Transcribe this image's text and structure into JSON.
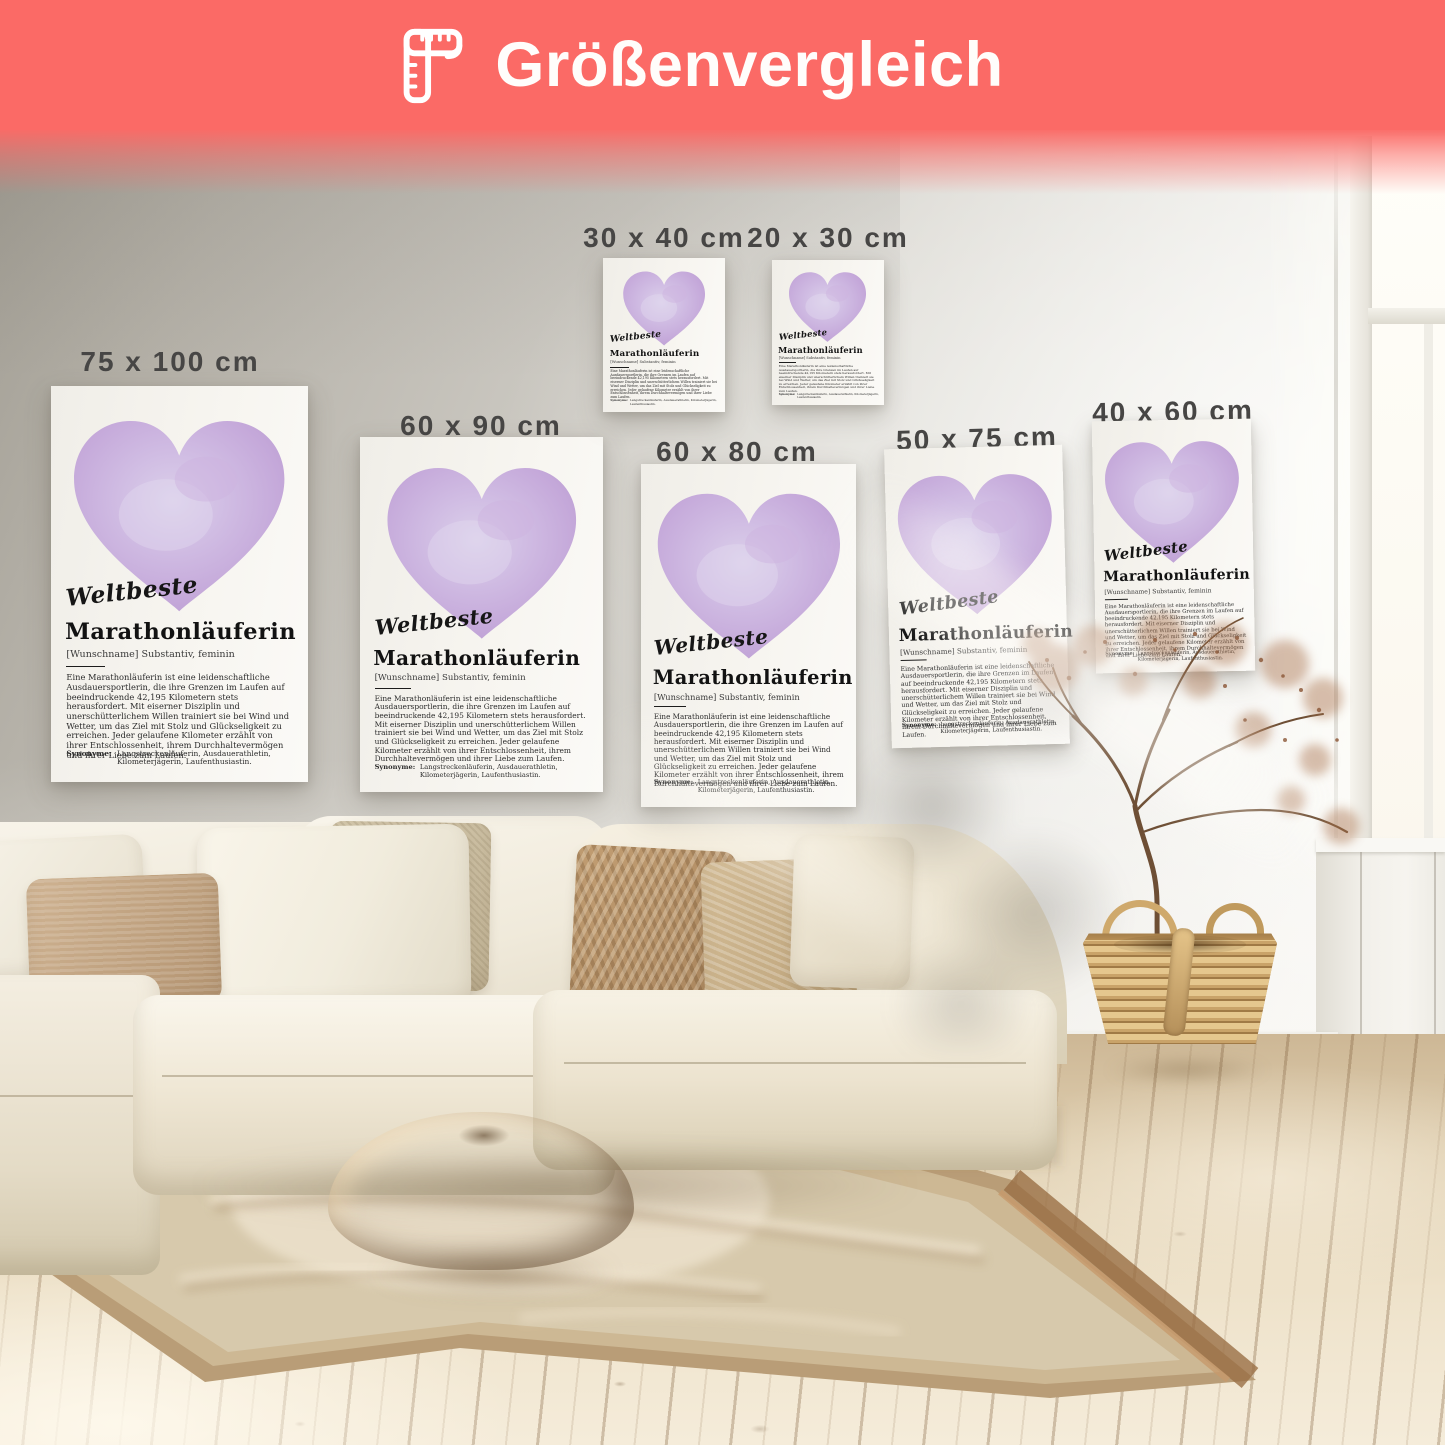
{
  "header": {
    "title": "Größenvergleich",
    "background_color": "#fb6a66",
    "text_color": "#fffdfb",
    "icon": "folding-ruler-icon"
  },
  "posters": {
    "sizes": [
      "75 x 100 cm",
      "60 x 90 cm",
      "30 x 40 cm",
      "20 x 30 cm",
      "60 x 80 cm",
      "50 x 75 cm",
      "40 x 60 cm"
    ],
    "content": {
      "script_word": "Weltbeste",
      "title": "Marathonläuferin",
      "subtitle": "[Wunschname] Substantiv, feminin",
      "body": "Eine Marathonläuferin ist eine leidenschaftliche Ausdauersportlerin, die ihre Grenzen im Laufen auf beeindruckende 42,195 Kilometern stets herausfordert. Mit eiserner Disziplin und unerschütterlichem Willen trainiert sie bei Wind und Wetter, um das Ziel mit Stolz und Glückseligkeit zu erreichen. Jeder gelaufene Kilometer erzählt von ihrer Entschlossenheit, ihrem Durchhaltevermögen und ihrer Liebe zum Laufen.",
      "synonyms_label": "Synonyme:",
      "synonyms": "Langstreckenläuferin, Ausdauerathletin, Kilometerjägerin, Laufenthusiastin.",
      "heart_color": "#c5a9da"
    }
  }
}
